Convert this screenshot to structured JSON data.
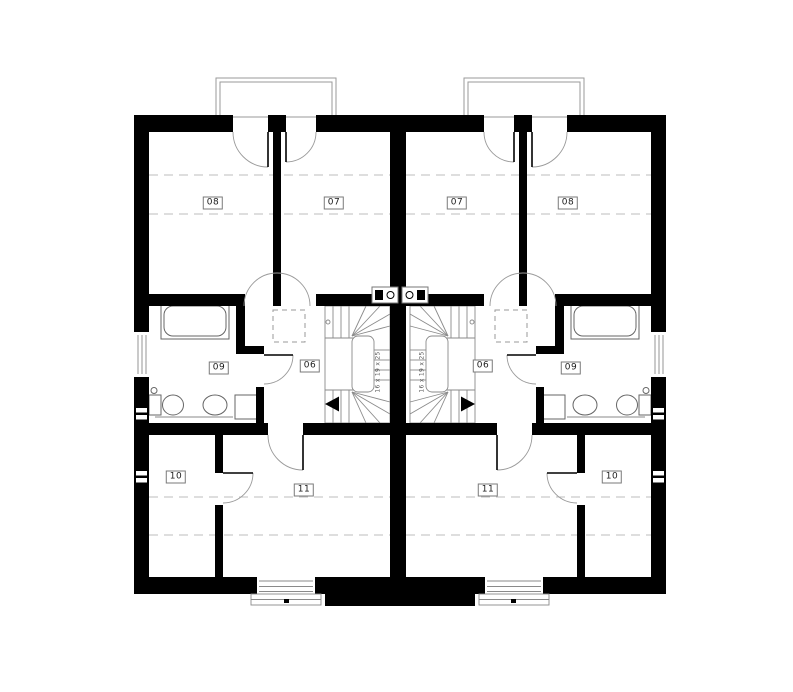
{
  "plan": {
    "title": "Semi-detached house upper floor plan",
    "room_labels": [
      {
        "text": "08",
        "unit": "left"
      },
      {
        "text": "07",
        "unit": "left"
      },
      {
        "text": "07",
        "unit": "right"
      },
      {
        "text": "08",
        "unit": "right"
      },
      {
        "text": "09",
        "unit": "left"
      },
      {
        "text": "06",
        "unit": "left"
      },
      {
        "text": "06",
        "unit": "right"
      },
      {
        "text": "09",
        "unit": "right"
      },
      {
        "text": "10",
        "unit": "left"
      },
      {
        "text": "11",
        "unit": "left"
      },
      {
        "text": "11",
        "unit": "right"
      },
      {
        "text": "10",
        "unit": "right"
      }
    ],
    "stairs": {
      "left_note": "16 x 19 x 25",
      "right_note": "16 x 19 x 25"
    },
    "colors": {
      "wall": "#000000",
      "thin_line": "#8a8a8a",
      "dashed_line": "#bcbcbc",
      "background": "#ffffff"
    }
  }
}
